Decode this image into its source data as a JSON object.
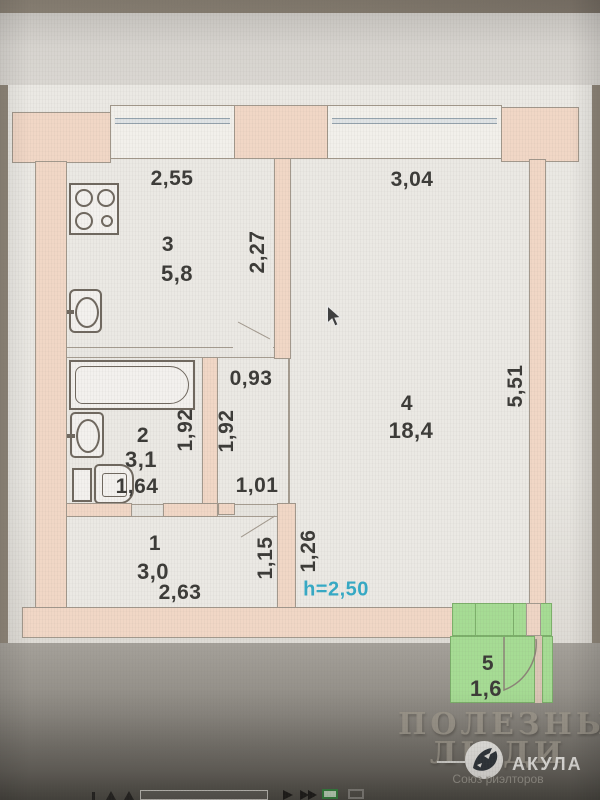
{
  "plan": {
    "rooms": {
      "kitchen": {
        "number": "3",
        "area": "5,8"
      },
      "bathroom": {
        "number": "2",
        "area": "3,1"
      },
      "hallway": {
        "number": "1",
        "area": "3,0"
      },
      "living": {
        "number": "4",
        "area": "18,4"
      },
      "balcony": {
        "number": "5",
        "area": "1,6"
      }
    },
    "dims": {
      "kitchen_width": "2,55",
      "living_width": "3,04",
      "kitchen_depth": "2,27",
      "corridor_width": "0,93",
      "bath_depth": "1,92",
      "corridor_depth": "1,92",
      "bath_width": "1,64",
      "corridor_opening": "1,01",
      "living_depth": "5,51",
      "hall_opening": "1,15",
      "living_wall": "1,26",
      "hall_width": "2,63",
      "ceiling_height": "h=2,50"
    }
  },
  "watermark": {
    "line1": "ПОЛЕЗНЫЕ",
    "line2": "ЛЮДИ"
  },
  "logo": {
    "brand": "АКУЛА",
    "subtitle": "Союз риэлторов"
  },
  "colors": {
    "wall": "#f1d7c6",
    "balcony_highlight": "#a6dc94",
    "ceiling_label": "#35aac6",
    "paper": "#eae8e3"
  }
}
